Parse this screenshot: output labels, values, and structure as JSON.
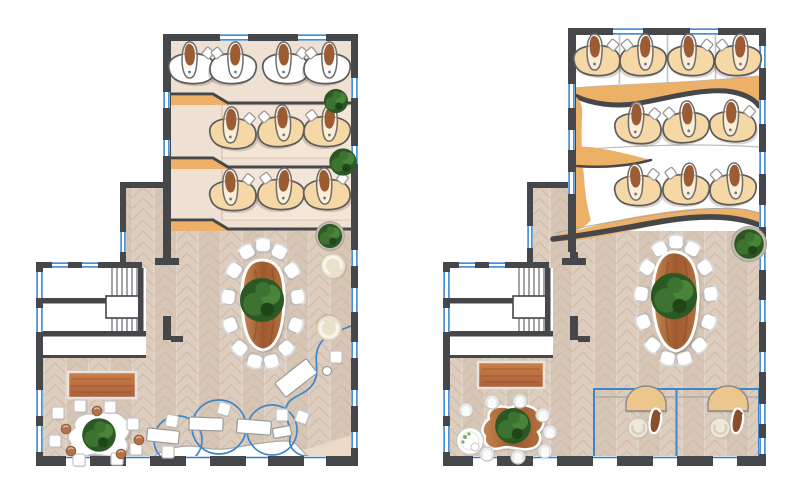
{
  "meta": {
    "title": "Two office floor plans, rendered top view"
  },
  "colors": {
    "wall": "#46474b",
    "window": "#2e7fd2",
    "glass": "#3e86c9",
    "floor_beige": "#eee0d2",
    "floor_wood": "#dccdbe",
    "wood_line": "#cdb9a8",
    "accent": "#ecb166",
    "tan_band": "#ecdac8",
    "desk_tan": "#f6d7a6",
    "desk_white": "#ffffff",
    "wood_light": "#c58551",
    "wood_dark": "#9e5a2e",
    "wood_mid": "#b4703f",
    "rug_light": "#cd8049",
    "rug_dark": "#a9603a",
    "green_dark": "#2c5824",
    "green_mid": "#3c7330",
    "green_light": "#4a8438",
    "green_deep": "#1f4519",
    "bench": "#f3e6d6",
    "bench_line": "#dcc9b6"
  },
  "plans": {
    "left": {
      "name": "floor-plan-level-1",
      "bottom_wall_y": 456,
      "wall_segments": [
        [
          36,
          30
        ],
        [
          90,
          36
        ],
        [
          150,
          36
        ],
        [
          210,
          36
        ],
        [
          268,
          36
        ],
        [
          326,
          32
        ]
      ],
      "windows": [
        [
          "h",
          220,
          34,
          28,
          7
        ],
        [
          "h",
          298,
          34,
          28,
          7
        ],
        [
          "h",
          52,
          262,
          16,
          6
        ],
        [
          "h",
          82,
          262,
          16,
          6
        ],
        [
          "v",
          351,
          78,
          20,
          7
        ],
        [
          "v",
          351,
          146,
          18,
          7
        ],
        [
          "v",
          351,
          250,
          16,
          7
        ],
        [
          "v",
          351,
          288,
          24,
          7
        ],
        [
          "v",
          351,
          342,
          16,
          7
        ],
        [
          "v",
          351,
          390,
          16,
          7
        ],
        [
          "v",
          351,
          432,
          16,
          7
        ],
        [
          "v",
          163,
          92,
          16,
          7
        ],
        [
          "v",
          163,
          140,
          16,
          7
        ],
        [
          "v",
          120,
          232,
          20,
          6
        ],
        [
          "v",
          36,
          272,
          26,
          7
        ],
        [
          "v",
          36,
          308,
          24,
          7
        ],
        [
          "v",
          36,
          390,
          26,
          7
        ],
        [
          "v",
          36,
          426,
          26,
          7
        ]
      ],
      "desks": [
        [
          192,
          68,
          "w",
          0,
          0
        ],
        [
          233,
          68,
          "w",
          1,
          0
        ],
        [
          286,
          68,
          "w",
          0,
          0
        ],
        [
          327,
          68,
          "w",
          1,
          0
        ],
        [
          233,
          133,
          "t",
          0,
          2
        ],
        [
          281,
          131,
          "t",
          1,
          -3
        ],
        [
          327,
          131,
          "t",
          1,
          2
        ],
        [
          233,
          195,
          "t",
          0,
          -2
        ],
        [
          281,
          194,
          "t",
          1,
          3
        ],
        [
          327,
          194,
          "t",
          0,
          -2
        ]
      ],
      "rings": [
        {
          "cx": 263,
          "cy": 304,
          "rx": 36,
          "ry": 60,
          "n": 13,
          "start": -90
        }
      ],
      "cubes": [
        [
          58,
          413,
          0
        ],
        [
          80,
          406,
          0
        ],
        [
          110,
          407,
          0
        ],
        [
          133,
          424,
          0
        ],
        [
          136,
          449,
          0
        ],
        [
          117,
          459,
          0
        ],
        [
          79,
          460,
          0
        ],
        [
          55,
          441,
          0
        ],
        [
          172,
          421,
          10
        ],
        [
          168,
          452,
          0
        ],
        [
          224,
          409,
          15
        ],
        [
          282,
          415,
          0
        ],
        [
          302,
          417,
          20
        ],
        [
          336,
          357,
          0
        ]
      ],
      "bstools": [
        [
          97,
          411
        ],
        [
          66,
          429
        ],
        [
          71,
          451
        ],
        [
          121,
          454
        ],
        [
          139,
          440
        ]
      ],
      "wstools": [],
      "deskRects": [
        [
          163,
          436,
          32,
          13,
          6
        ],
        [
          206,
          424,
          34,
          13,
          2
        ],
        [
          254,
          427,
          34,
          14,
          4
        ],
        [
          296,
          378,
          40,
          18,
          -38
        ],
        [
          282,
          432,
          18,
          10,
          -10
        ]
      ],
      "smallCircles": [
        [
          327,
          371
        ]
      ],
      "lounges": [
        [
          333,
          266,
          -20
        ],
        [
          329,
          328,
          195
        ]
      ],
      "rtables": [],
      "podDesks": [],
      "plants": [
        [
          336,
          101,
          1.15,
          0
        ],
        [
          343,
          162,
          1.3,
          0
        ],
        [
          330,
          236,
          1.15,
          1
        ],
        [
          262,
          300,
          2.1,
          0
        ],
        [
          99,
          435,
          1.6,
          0
        ]
      ]
    },
    "right": {
      "name": "floor-plan-level-2",
      "bottom_wall_y": 456,
      "wall_segments": [
        [
          443,
          30
        ],
        [
          497,
          36
        ],
        [
          557,
          36
        ],
        [
          617,
          36
        ],
        [
          677,
          36
        ],
        [
          737,
          29
        ]
      ],
      "windows": [
        [
          "h",
          613,
          28,
          30,
          7
        ],
        [
          "h",
          690,
          28,
          28,
          7
        ],
        [
          "h",
          459,
          262,
          16,
          6
        ],
        [
          "h",
          489,
          262,
          16,
          6
        ],
        [
          "v",
          759,
          46,
          22,
          7
        ],
        [
          "v",
          759,
          100,
          24,
          7
        ],
        [
          "v",
          759,
          152,
          22,
          7
        ],
        [
          "v",
          759,
          205,
          22,
          7
        ],
        [
          "v",
          759,
          250,
          20,
          7
        ],
        [
          "v",
          759,
          300,
          22,
          7
        ],
        [
          "v",
          759,
          352,
          20,
          7
        ],
        [
          "v",
          759,
          404,
          20,
          7
        ],
        [
          "v",
          759,
          438,
          16,
          7
        ],
        [
          "v",
          568,
          84,
          24,
          7
        ],
        [
          "v",
          568,
          130,
          20,
          7
        ],
        [
          "v",
          568,
          172,
          22,
          7
        ],
        [
          "v",
          527,
          226,
          22,
          6
        ],
        [
          "v",
          443,
          272,
          26,
          7
        ],
        [
          "v",
          443,
          308,
          24,
          7
        ],
        [
          "v",
          443,
          390,
          26,
          7
        ],
        [
          "v",
          443,
          426,
          26,
          7
        ]
      ],
      "desks": [
        [
          597,
          60,
          "t",
          0,
          0
        ],
        [
          643,
          60,
          "t",
          1,
          0
        ],
        [
          691,
          60,
          "t",
          0,
          0
        ],
        [
          738,
          60,
          "t",
          1,
          0
        ],
        [
          638,
          128,
          "t",
          0,
          3
        ],
        [
          686,
          127,
          "t",
          1,
          -4
        ],
        [
          733,
          126,
          "t",
          0,
          2
        ],
        [
          638,
          190,
          "t",
          0,
          -2
        ],
        [
          686,
          189,
          "t",
          1,
          3
        ],
        [
          733,
          189,
          "t",
          1,
          -3
        ]
      ],
      "rings": [
        {
          "cx": 676,
          "cy": 301,
          "rx": 36,
          "ry": 60,
          "n": 13,
          "start": -90
        }
      ],
      "cubes": [],
      "bstools": [],
      "wstools": [
        [
          466,
          410
        ],
        [
          492,
          402
        ],
        [
          520,
          401
        ],
        [
          543,
          415
        ],
        [
          550,
          432
        ],
        [
          545,
          451
        ],
        [
          518,
          457
        ],
        [
          487,
          454
        ]
      ],
      "deskRects": [],
      "smallCircles": [],
      "lounges": [],
      "rtables": [
        [
          470,
          441
        ]
      ],
      "podDesks": [
        [
          646,
          404,
          0
        ],
        [
          728,
          404,
          0
        ]
      ],
      "plants": [
        [
          749,
          244,
          1.4,
          1
        ],
        [
          674,
          296,
          2.2,
          0
        ],
        [
          513,
          426,
          1.7,
          0
        ]
      ]
    }
  }
}
